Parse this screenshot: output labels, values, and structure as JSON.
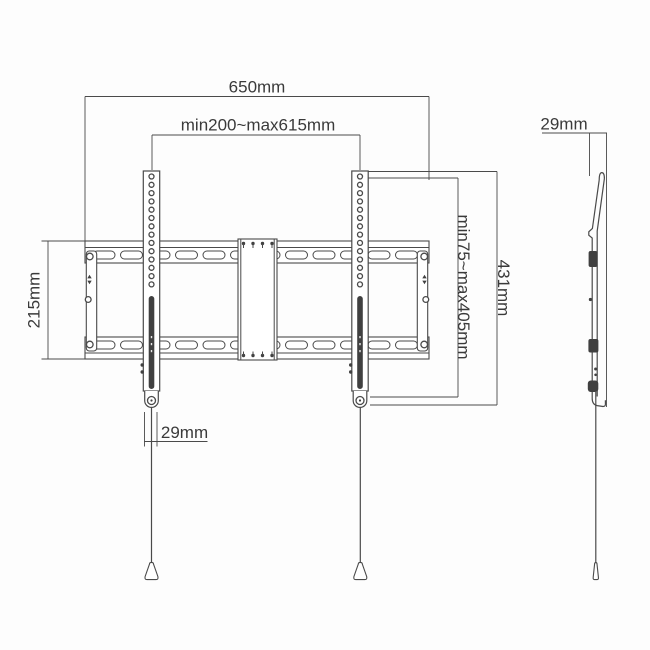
{
  "meta": {
    "title": "TV wall mount dimension drawing",
    "front_view": "front view",
    "side_view": "side view"
  },
  "dimensions": {
    "total_width": "650mm",
    "tv_hole_width_range": "min200~max615mm",
    "wall_plate_height": "215mm",
    "bracket_height": "431mm",
    "tv_hole_height_range": "min75~max405mm",
    "arm_bottom_width": "29mm",
    "profile_depth": "29mm"
  },
  "colors": {
    "line": "#4a4a4a",
    "text": "#3a3a3a",
    "background": "#fdfdfd",
    "dark_fill": "#404040"
  }
}
